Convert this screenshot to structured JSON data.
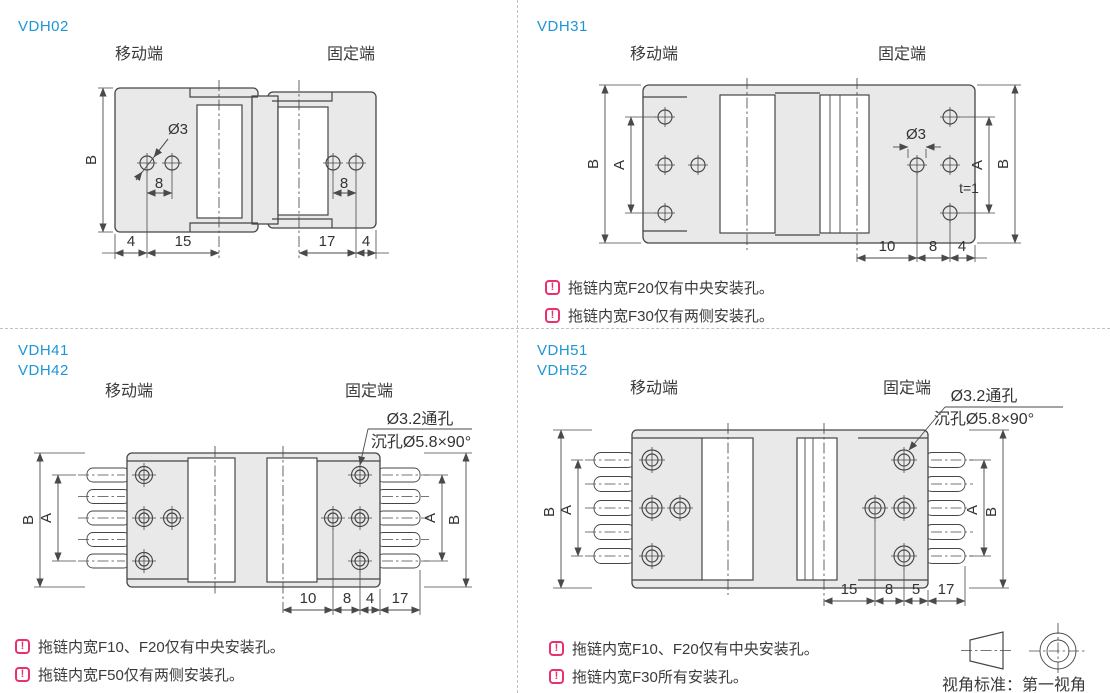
{
  "colors": {
    "model_blue": "#1e95d5",
    "note_pink": "#e8316f",
    "line_gray": "#464646",
    "fill_gray": "#e9e9e9"
  },
  "shared": {
    "moving_end": "移动端",
    "fixed_end": "固定端",
    "note_icon": "!"
  },
  "panels": {
    "vdh02": {
      "models": [
        "VDH02"
      ],
      "dims": {
        "B": "B",
        "hole": "Ø3",
        "pitch_left": "8",
        "pitch_right": "8",
        "b1": "4",
        "b2": "15",
        "b3": "17",
        "b4": "4"
      }
    },
    "vdh31": {
      "models": [
        "VDH31"
      ],
      "dims": {
        "B": "B",
        "A": "A",
        "hole": "Ø3",
        "thickness": "t=1",
        "b1": "10",
        "b2": "8",
        "b3": "4"
      },
      "notes": [
        {
          "text": "拖链内宽F20仅有中央安装孔。"
        },
        {
          "text": "拖链内宽F30仅有两侧安装孔。"
        }
      ]
    },
    "vdh41": {
      "models": [
        "VDH41",
        "VDH42"
      ],
      "callout": {
        "line1": "Ø3.2通孔",
        "line2": "沉孔Ø5.8×90°"
      },
      "dims": {
        "B": "B",
        "A": "A",
        "b1": "10",
        "b2": "8",
        "b3": "4",
        "b4": "17"
      },
      "notes": [
        {
          "text": "拖链内宽F10、F20仅有中央安装孔。"
        },
        {
          "text": "拖链内宽F50仅有两侧安装孔。"
        }
      ]
    },
    "vdh51": {
      "models": [
        "VDH51",
        "VDH52"
      ],
      "callout": {
        "line1": "Ø3.2通孔",
        "line2": "沉孔Ø5.8×90°"
      },
      "dims": {
        "B": "B",
        "A": "A",
        "b1": "15",
        "b2": "8",
        "b3": "5",
        "b4": "17"
      },
      "notes": [
        {
          "text": "拖链内宽F10、F20仅有中央安装孔。"
        },
        {
          "text": "拖链内宽F30所有安装孔。"
        }
      ]
    }
  },
  "projection": {
    "caption": "视角标准：第一视角"
  }
}
